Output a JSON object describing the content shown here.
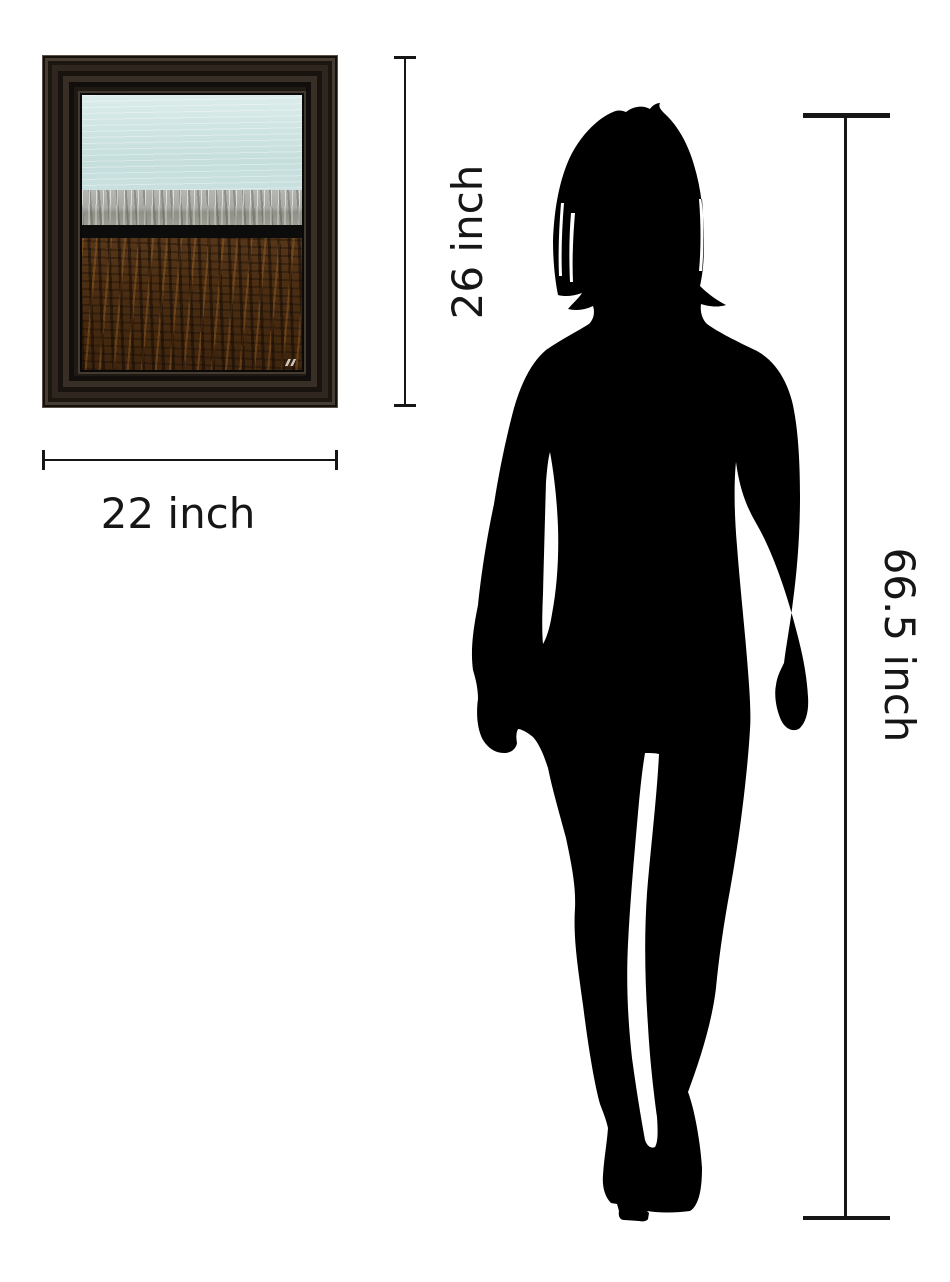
{
  "canvas": {
    "width": 950,
    "height": 1282,
    "background": "#ffffff"
  },
  "colors": {
    "page": "#ffffff",
    "ink": "#161616",
    "silhouette": "#000000",
    "frame-outer-highlight": "#5a5248",
    "frame-dark": "#141009",
    "frame-mid": "#2e261f",
    "frame-ridge": "#453c33",
    "painting-sky": "#cbe2e0",
    "painting-silver": "#a5a7a0",
    "painting-black": "#0c0c0c",
    "painting-brown": "#4a2d12"
  },
  "artwork": {
    "type": "framed-abstract-painting",
    "frame_color": "#241e18",
    "bands": [
      {
        "name": "sky",
        "color": "#cbe2e0"
      },
      {
        "name": "silver",
        "color": "#a5a7a0"
      },
      {
        "name": "black",
        "color": "#0c0c0c"
      },
      {
        "name": "brown",
        "color": "#4a2d12"
      }
    ]
  },
  "dimension_annotations": {
    "artwork_width": {
      "label": "22 inch"
    },
    "artwork_height": {
      "label": "26 inch"
    },
    "figure_height": {
      "label": "66.5 inch"
    }
  },
  "figure": {
    "type": "standing-female-silhouette",
    "color": "#000000"
  }
}
